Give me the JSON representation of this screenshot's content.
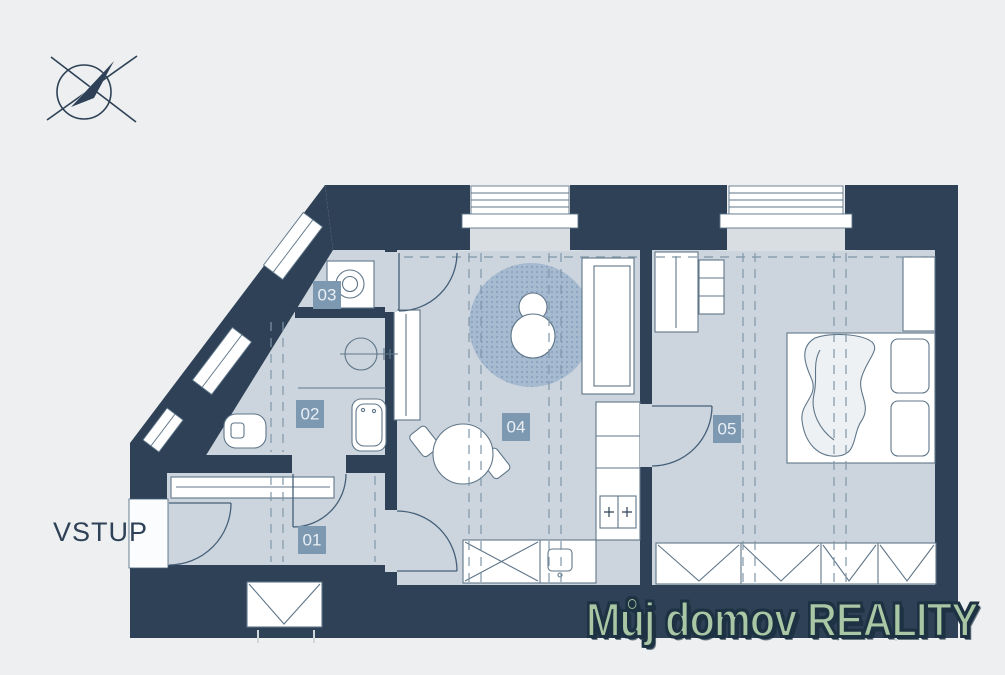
{
  "canvas": {
    "width": 1005,
    "height": 675,
    "background": "#edeff0"
  },
  "entrance": {
    "label": "VSTUP"
  },
  "rooms": [
    {
      "id": "01"
    },
    {
      "id": "02"
    },
    {
      "id": "03"
    },
    {
      "id": "04"
    },
    {
      "id": "05"
    }
  ],
  "watermark": {
    "text": "Můj domov REALITY"
  },
  "icons": [
    "compass-icon",
    "washing-machine-icon",
    "toilet-icon",
    "washbasin-icon",
    "bathtub-icon",
    "sofa-icon",
    "armchair-icon",
    "rug-icon",
    "dining-table-icon",
    "kitchen-counter-icon",
    "stove-icon",
    "sink-icon",
    "bed-icon",
    "wardrobe-icon",
    "door-icon",
    "window-icon"
  ],
  "colors": {
    "wall": "#2e4156",
    "floor": "#ccd5dd",
    "window_recess": "#d9dee3",
    "badge": "#7d99b2",
    "badge_text": "#e9eff4",
    "rug": "#9cb2ca",
    "furniture_stroke": "#5f7689",
    "dash": "#8096a8",
    "watermark_fill": "#a9c7a4",
    "watermark_outline": "#1d3242",
    "text": "#2e4156"
  }
}
